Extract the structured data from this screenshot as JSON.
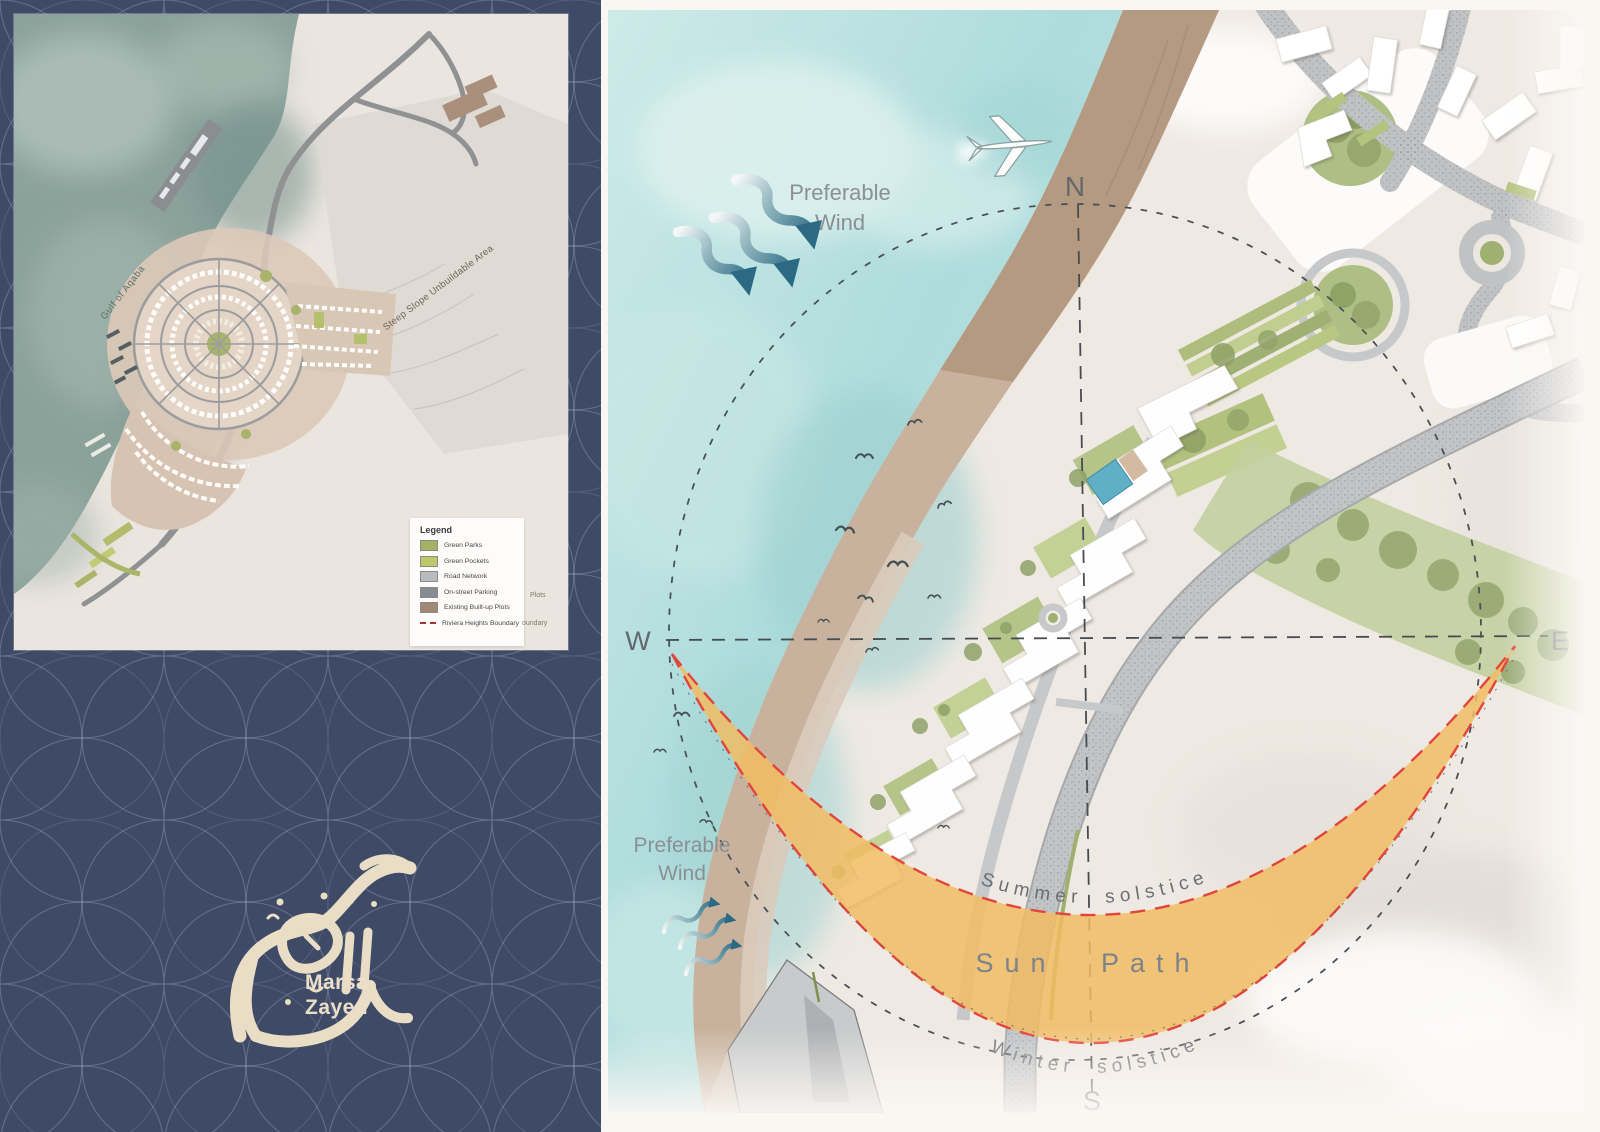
{
  "branding": {
    "name_line1": "Marsa",
    "name_line2": "Zayed",
    "logo_icon": "arabic-calligraphy-logo"
  },
  "inset_map": {
    "sea_label": "Gulf of Aqaba",
    "terrain_label": "Steep Slope Unbuildable Area",
    "legend": {
      "title": "Legend",
      "items": [
        {
          "label": "Green Parks",
          "color": "#a4b266"
        },
        {
          "label": "Green Pockets",
          "color": "#bdc968"
        },
        {
          "label": "Road Network",
          "color": "#b9bcbf"
        },
        {
          "label": "On-street Parking",
          "color": "#868c91"
        },
        {
          "label": "Existing Built-up Plots",
          "color": "#a28875"
        },
        {
          "label": "Riviera Heights Boundary",
          "color": "#a8362e",
          "swatch_style": "dashed-line"
        }
      ],
      "ghost_fragment_1": "Plots",
      "ghost_fragment_2": "oundary"
    }
  },
  "analysis_map": {
    "compass": {
      "n": "N",
      "e": "E",
      "s": "S",
      "w": "W"
    },
    "sun_path": {
      "summer_label": "Summer solstice",
      "band_label": "Sun Path",
      "winter_label": "Winter solstice",
      "band_color": "#f1bc63",
      "boundary_color": "#e2453c"
    },
    "wind_upper": {
      "line1": "Preferable",
      "line2": "Wind"
    },
    "wind_lower": {
      "line1": "Preferable",
      "line2": "Wind"
    },
    "icons": {
      "airplane": "airplane-icon",
      "birds": "bird-icon",
      "wind_arrows": "wind-arrow-icon"
    },
    "colors": {
      "sea": "#b5dedc",
      "beach": "#c8b29d",
      "cliff": "#b2977f",
      "road": "#c0c2c4",
      "park": "#c3cfa0",
      "panel_navy": "#3e4a66"
    }
  }
}
